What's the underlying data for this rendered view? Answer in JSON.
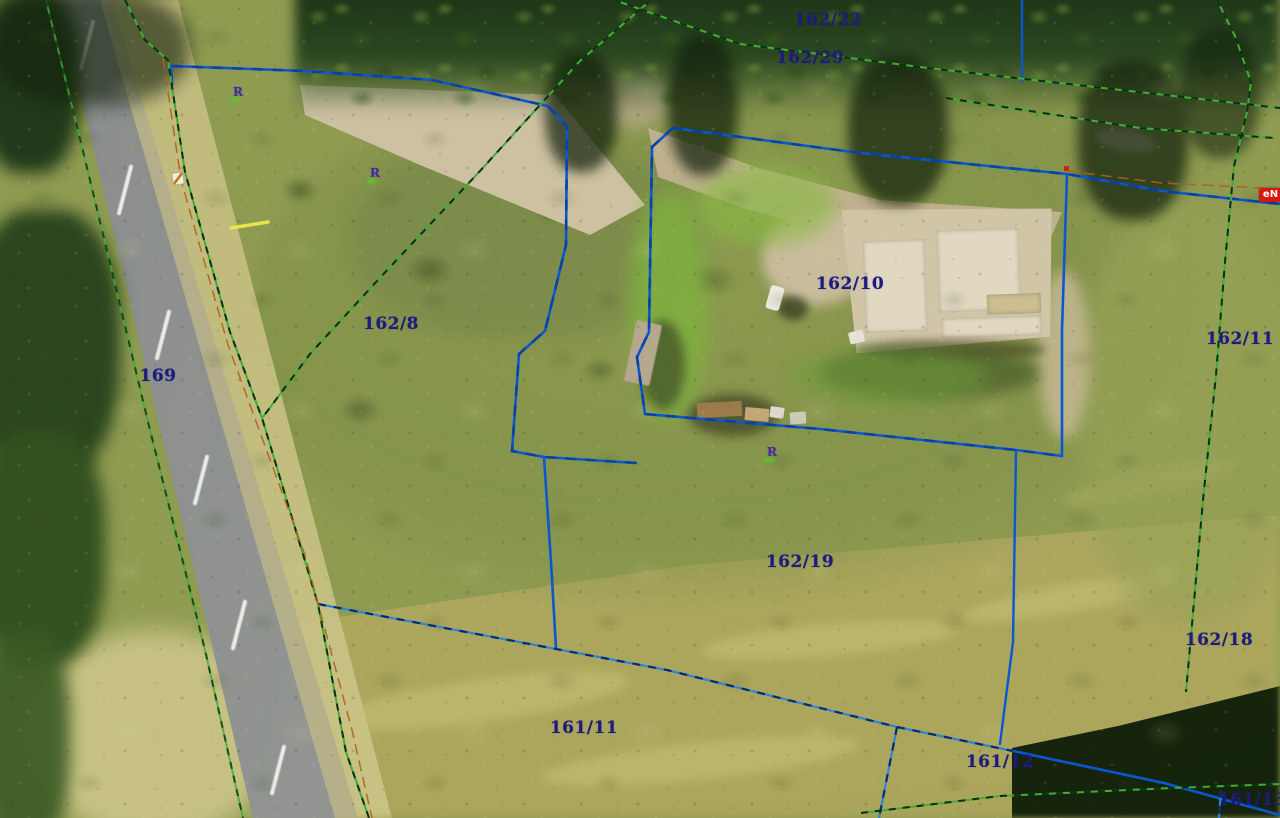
{
  "map": {
    "description": "Aerial orthophoto with cadastral parcel boundary overlay",
    "parcel_labels": [
      {
        "text": "162/22",
        "x": 828,
        "y": 20
      },
      {
        "text": "162/29",
        "x": 810,
        "y": 58
      },
      {
        "text": "162/8",
        "x": 391,
        "y": 324
      },
      {
        "text": "162/10",
        "x": 850,
        "y": 284
      },
      {
        "text": "162/11",
        "x": 1240,
        "y": 339
      },
      {
        "text": "169",
        "x": 158,
        "y": 376
      },
      {
        "text": "162/19",
        "x": 800,
        "y": 562
      },
      {
        "text": "162/18",
        "x": 1219,
        "y": 640
      },
      {
        "text": "161/11",
        "x": 584,
        "y": 728
      },
      {
        "text": "161/12",
        "x": 1000,
        "y": 762
      },
      {
        "text": "161/13",
        "x": 1252,
        "y": 800
      }
    ],
    "point_markers": [
      {
        "text": "R",
        "x": 238,
        "y": 92
      },
      {
        "text": "R",
        "x": 375,
        "y": 173
      },
      {
        "text": "R",
        "x": 772,
        "y": 452
      }
    ],
    "badges": {
      "en": {
        "text": "eN",
        "color": "#d6180e"
      }
    },
    "colors": {
      "parcel_label": "#1c1c80",
      "boundary_solid_blue": "#0b57d0",
      "boundary_dashed_blue": "#2e86d4",
      "boundary_dashed_green": "#3fae35",
      "utility_orange": "#b06018",
      "survey_marker_purple": "#4a2a9a",
      "highlight_yellow": "#e8e24c",
      "marker_red": "#cc2211"
    }
  }
}
